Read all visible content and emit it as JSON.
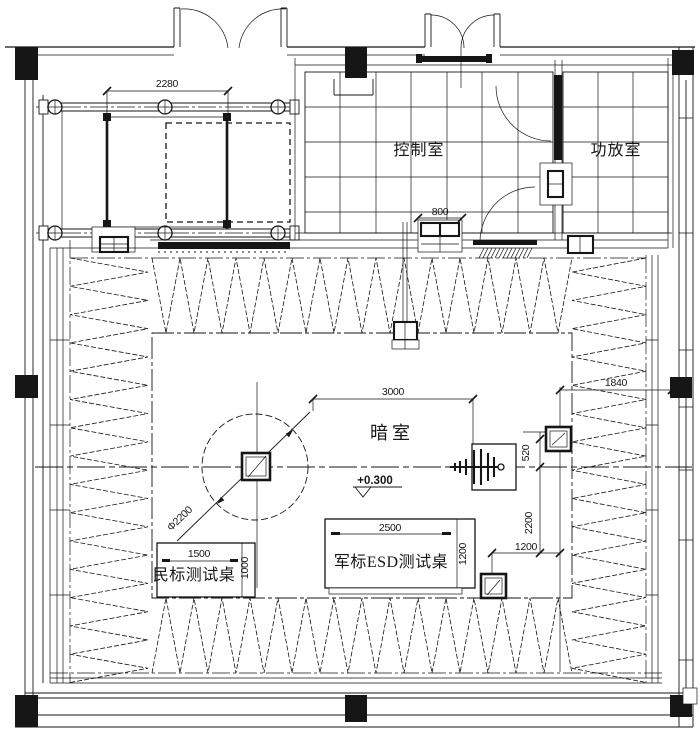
{
  "drawing": {
    "type": "anechoic-chamber-floor-plan",
    "rooms": {
      "control_room": "控制室",
      "amplifier_room": "功放室",
      "anechoic_chamber": "暗室"
    },
    "equipment": {
      "military_esd_table": "军标ESD测试桌",
      "civil_test_table": "民标测试桌"
    },
    "annotations": {
      "floor_level": "+0.300",
      "turntable_diameter": "Φ2200"
    },
    "dimensions": {
      "sliding_door_width": "2280",
      "pass_window_width": "800",
      "quiet_zone_length": "3000",
      "right_clearance": "1840",
      "camera_offset": "520",
      "antenna_axis_depth": "2200",
      "camera_bottom_offset": "1200",
      "esd_table_length": "2500",
      "esd_table_width": "1200",
      "civil_table_length": "1500",
      "civil_table_width": "1000"
    },
    "colors": {
      "ink": "#161616",
      "paper": "#ffffff"
    }
  }
}
